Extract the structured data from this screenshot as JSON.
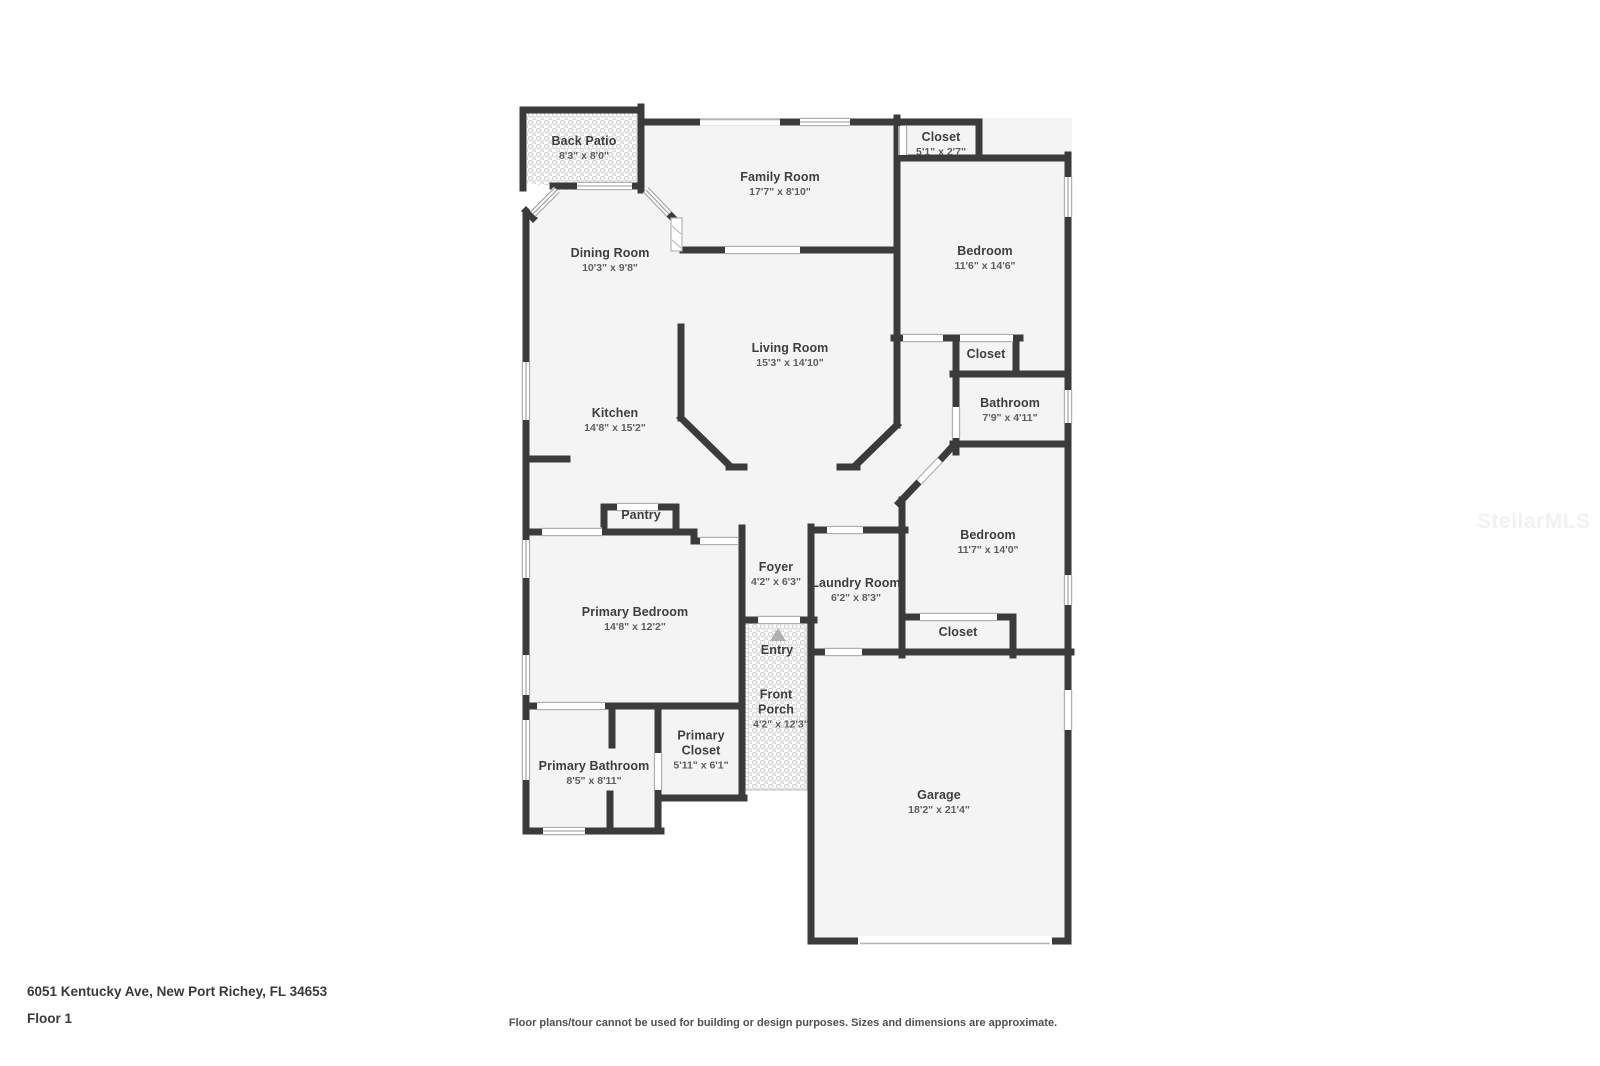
{
  "page": {
    "address": "6051 Kentucky Ave, New Port Richey, FL 34653",
    "floor_label": "Floor 1",
    "disclaimer": "Floor plans/tour cannot be used for building or design purposes. Sizes and dimensions are approximate.",
    "watermark": "StellarMLS"
  },
  "rooms": [
    {
      "id": "back-patio",
      "name": "Back Patio",
      "dims": "8'3\" x 8'0\""
    },
    {
      "id": "family-room",
      "name": "Family Room",
      "dims": "17'7\" x 8'10\""
    },
    {
      "id": "closet-top",
      "name": "Closet",
      "dims": "5'1\" x 2'7\""
    },
    {
      "id": "bedroom-1",
      "name": "Bedroom",
      "dims": "11'6\" x 14'6\""
    },
    {
      "id": "dining-room",
      "name": "Dining Room",
      "dims": "10'3\" x 9'8\""
    },
    {
      "id": "living-room",
      "name": "Living Room",
      "dims": "15'3\" x 14'10\""
    },
    {
      "id": "closet-bedroom-1",
      "name": "Closet",
      "dims": ""
    },
    {
      "id": "bathroom",
      "name": "Bathroom",
      "dims": "7'9\" x 4'11\""
    },
    {
      "id": "kitchen",
      "name": "Kitchen",
      "dims": "14'8\" x 15'2\""
    },
    {
      "id": "pantry",
      "name": "Pantry",
      "dims": ""
    },
    {
      "id": "bedroom-2",
      "name": "Bedroom",
      "dims": "11'7\" x 14'0\""
    },
    {
      "id": "foyer",
      "name": "Foyer",
      "dims": "4'2\" x 6'3\""
    },
    {
      "id": "laundry-room",
      "name": "Laundry Room",
      "dims": "6'2\" x 8'3\""
    },
    {
      "id": "primary-bedroom",
      "name": "Primary Bedroom",
      "dims": "14'8\" x 12'2\""
    },
    {
      "id": "entry",
      "name": "Entry",
      "dims": ""
    },
    {
      "id": "closet-bedroom-2",
      "name": "Closet",
      "dims": ""
    },
    {
      "id": "front-porch",
      "name": "Front Porch",
      "dims": "4'2\" x 12'3\""
    },
    {
      "id": "primary-closet",
      "name": "Primary Closet",
      "dims": "5'11\" x 6'1\""
    },
    {
      "id": "primary-bathroom",
      "name": "Primary Bathroom",
      "dims": "8'5\" x 8'11\""
    },
    {
      "id": "garage",
      "name": "Garage",
      "dims": "18'2\" x 21'4\""
    }
  ]
}
